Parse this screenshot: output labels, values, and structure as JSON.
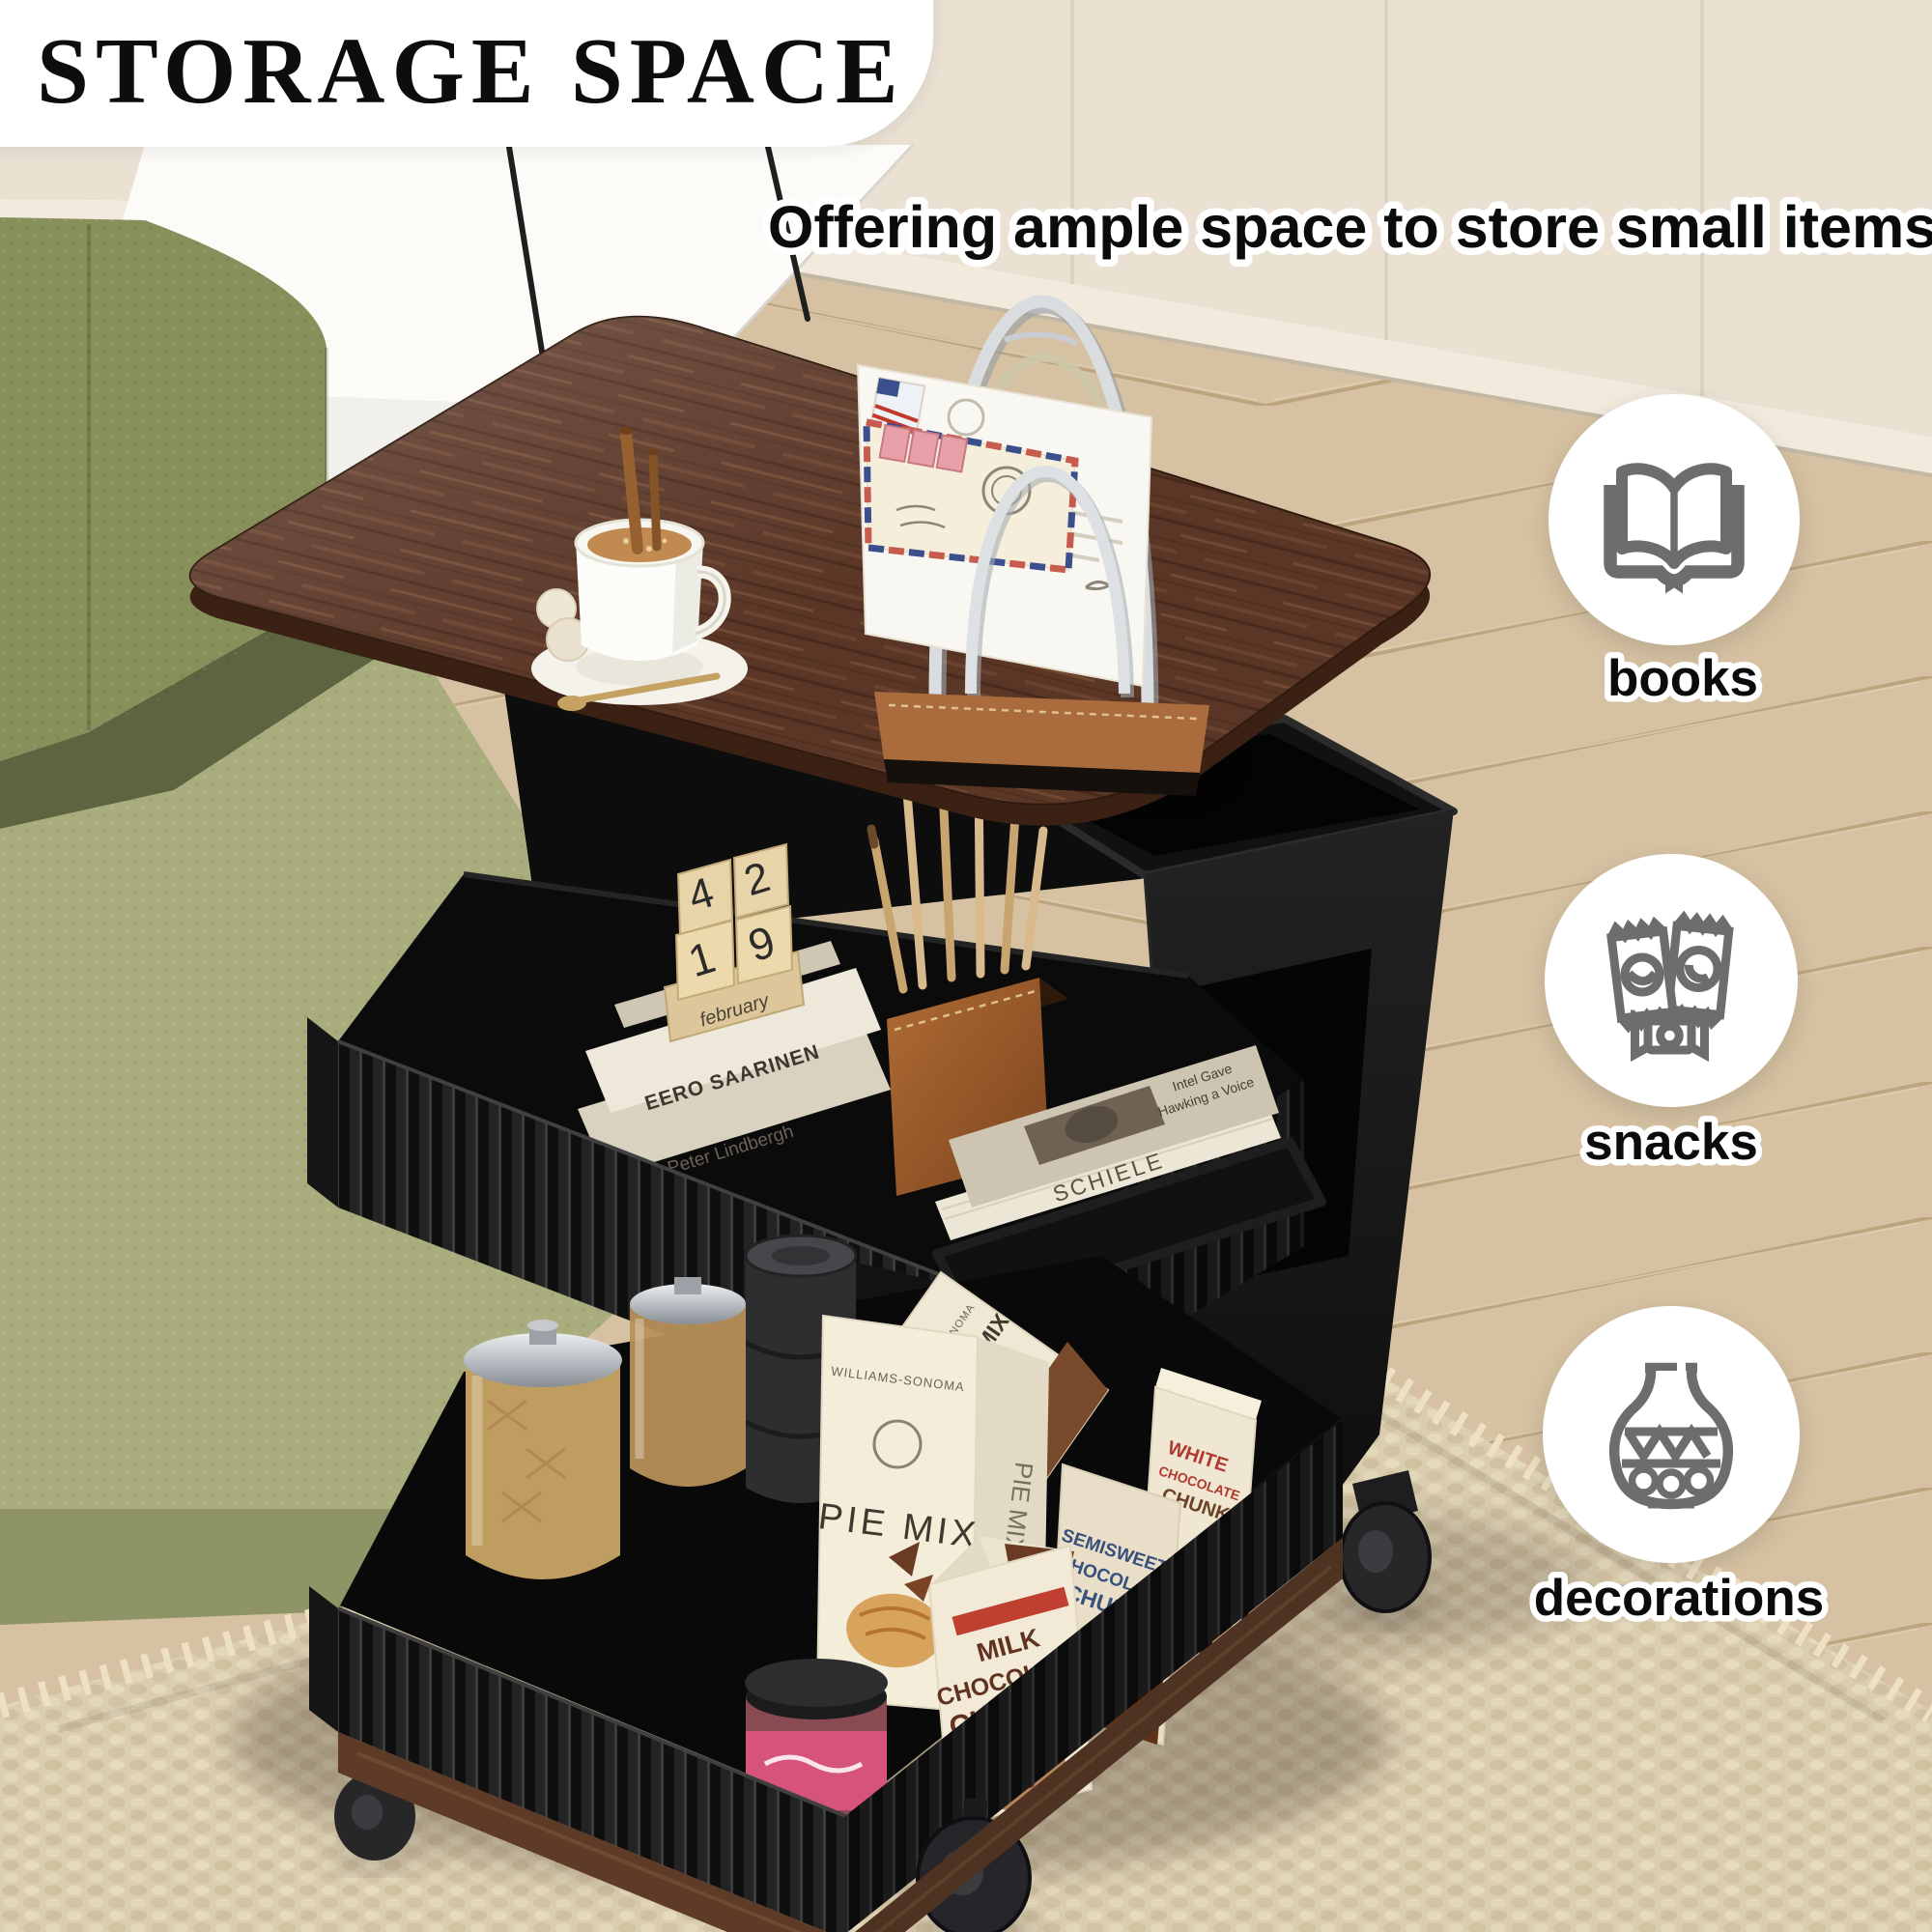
{
  "title": "STORAGE SPACE",
  "subtitle": "Offering ample space to store small items",
  "features": [
    {
      "label": "books",
      "icon": "open-book-icon"
    },
    {
      "label": "snacks",
      "icon": "snack-packets-icon"
    },
    {
      "label": "decorations",
      "icon": "vase-icon"
    }
  ],
  "scene": {
    "calendar": {
      "digit_top_left": "4",
      "digit_top_right": "2",
      "digit_bottom_left": "1",
      "digit_bottom_right": "9",
      "month": "february"
    },
    "drawer_books": {
      "top_spine": "EERO SAARINEN",
      "bottom_spine": "Peter Lindbergh"
    },
    "shelf_books": {
      "cover_line1": "Intel Gave",
      "cover_line2": "Hawking a Voice",
      "spine": "SCHIELE"
    },
    "pantry": {
      "brand": "WILLIAMS-SONOMA",
      "pie_box": "PIE MIX",
      "brownie_box": "BROWNIE MIX",
      "milk_box_lines": [
        "MILK",
        "CHOCOLATE",
        "CHUNKS"
      ],
      "semisweet_box_lines": [
        "SEMISWEET",
        "CHOCOLATE",
        "CHUNKS"
      ],
      "white_box_lines": [
        "WHITE",
        "CHOCOLATE",
        "CHUNKS"
      ]
    }
  },
  "palette": {
    "headline": "#0d0d0d",
    "halo": "#ffffff",
    "icon_gray": "#6d6d6d",
    "tabletop_wood": "#5a3626",
    "cabinet_black": "#141414",
    "sofa_green": "#87905a",
    "sofa_seat": "#a9ad7e",
    "floor_oak": "#d6c2a2",
    "wall_cream": "#eae1d3",
    "rug_beige": "#dbcdb0",
    "leather": "#a5642f",
    "base_walnut": "#5d3b26",
    "chrome": "#d9dde0"
  }
}
